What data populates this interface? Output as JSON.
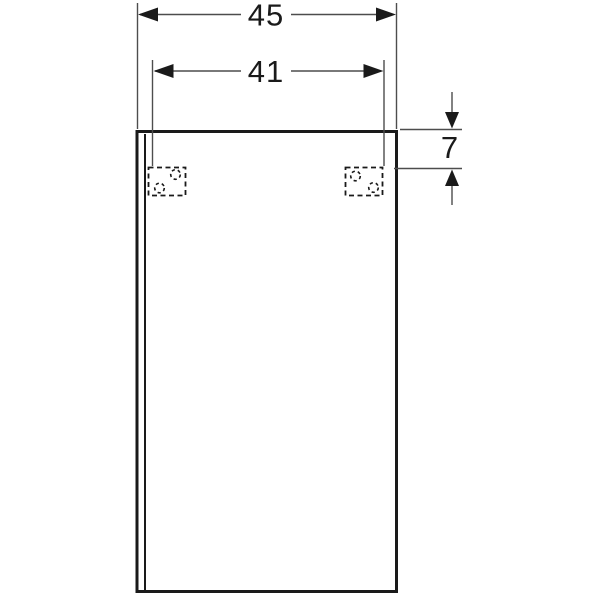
{
  "drawing": {
    "type": "technical-dimension-drawing",
    "subject": "wall-mounted cabinet, front view",
    "dimensions": {
      "overall_width": "45",
      "mounting_distance": "41",
      "top_offset": "7"
    },
    "components": {
      "cabinet_front": "rectangular front panel with door gap line on left edge",
      "mounting_bracket_left": "dashed wall-mount bracket with two dashed screw holes",
      "mounting_bracket_right": "dashed wall-mount bracket with two dashed screw holes"
    }
  },
  "colors": {
    "ink": "#1a1a1a",
    "dim": "#4d4d4d",
    "bg": "#ffffff"
  }
}
